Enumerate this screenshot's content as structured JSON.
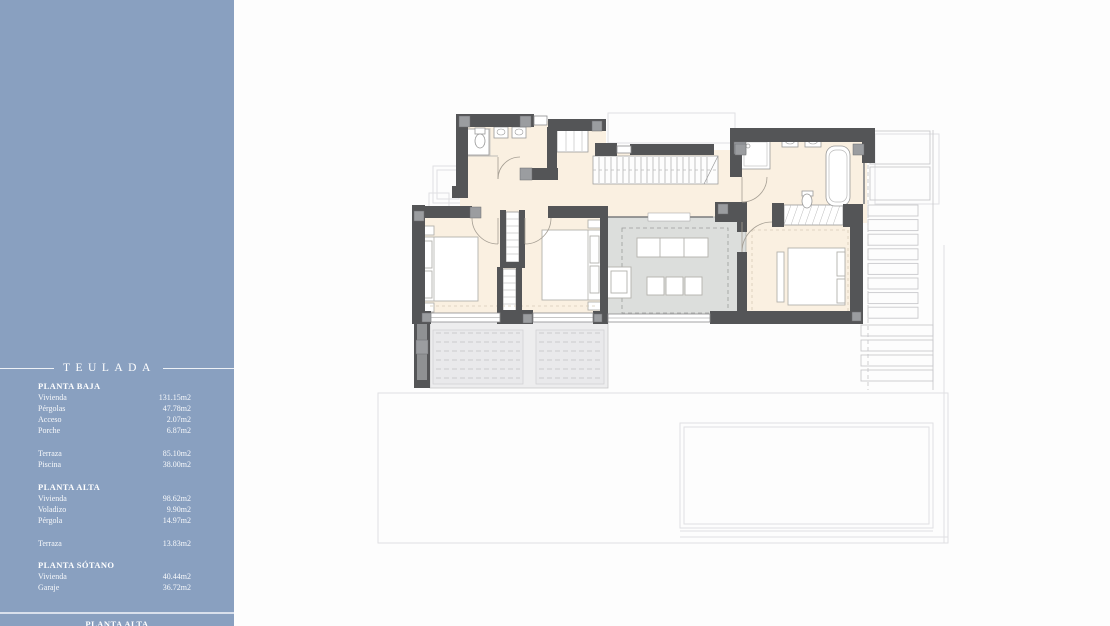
{
  "colors": {
    "sidebar_bg": "#89a0c0",
    "canvas_bg": "#fdfdfd",
    "wall": "#545557",
    "wall_light": "#9b9da0",
    "room_fill": "#faf0e1",
    "void_fill": "#dcdedc",
    "terrace_fill": "#ededee",
    "sidebar_text": "#ffffff"
  },
  "sidebar": {
    "title": "TEULADA",
    "sections": [
      {
        "heading": "PLANTA BAJA",
        "groups": [
          [
            {
              "label": "Vivienda",
              "value": "131.15m2"
            },
            {
              "label": "Pérgolas",
              "value": "47.78m2"
            },
            {
              "label": "Acceso",
              "value": "2.07m2"
            },
            {
              "label": "Porche",
              "value": "6.87m2"
            }
          ],
          [
            {
              "label": "Terraza",
              "value": "85.10m2"
            },
            {
              "label": "Piscina",
              "value": "38.00m2"
            }
          ]
        ]
      },
      {
        "heading": "PLANTA ALTA",
        "groups": [
          [
            {
              "label": "Vivienda",
              "value": "98.62m2"
            },
            {
              "label": "Voladizo",
              "value": "9.90m2"
            },
            {
              "label": "Pérgola",
              "value": "14.97m2"
            }
          ],
          [
            {
              "label": "Terraza",
              "value": "13.83m2"
            }
          ]
        ]
      },
      {
        "heading": "PLANTA SÓTANO",
        "groups": [
          [
            {
              "label": "Vivienda",
              "value": "40.44m2"
            },
            {
              "label": "Garaje",
              "value": "36.72m2"
            }
          ]
        ]
      }
    ],
    "footer_heading": "PLANTA ALTA"
  }
}
